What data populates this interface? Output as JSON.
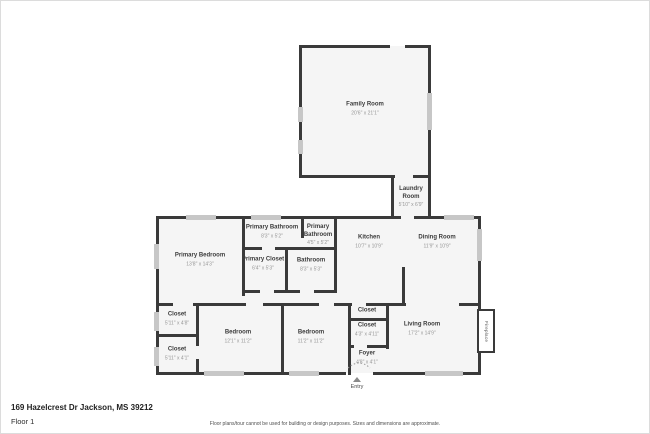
{
  "address": "169 Hazelcrest Dr Jackson, MS 39212",
  "floor_label": "Floor 1",
  "disclaimer": "Floor plans/tour cannot be used for building or design purposes. Sizes and dimensions are approximate.",
  "entry_label": "Entry",
  "fireplace_label": "Fireplace",
  "colors": {
    "wall": "#3a3a3a",
    "window": "#c7c7c7",
    "room_fill": "#f5f5f5",
    "room_name_text": "#3c3c3c",
    "dimension_text": "#979797"
  },
  "rooms": [
    {
      "name": "Family Room",
      "dims": "20'6\" x 21'1\""
    },
    {
      "name": "Laundry Room",
      "dims": "5'10\" x 6'9\""
    },
    {
      "name": "Primary Bathroom",
      "dims": "8'3\" x 5'2\""
    },
    {
      "name": "Primary Bathroom",
      "dims": "4'5\" x 5'2\""
    },
    {
      "name": "Kitchen",
      "dims": "10'7\" x 10'9\""
    },
    {
      "name": "Dining Room",
      "dims": "11'9\" x 10'9\""
    },
    {
      "name": "Primary Bedroom",
      "dims": "13'8\" x 14'3\""
    },
    {
      "name": "Primary Closet",
      "dims": "6'4\" x 5'3\""
    },
    {
      "name": "Bathroom",
      "dims": "8'3\" x 5'3\""
    },
    {
      "name": "Closet",
      "dims": "5'11\" x 4'8\""
    },
    {
      "name": "Closet",
      "dims": "5'11\" x 4'1\""
    },
    {
      "name": "Bedroom",
      "dims": "12'1\" x 11'2\""
    },
    {
      "name": "Bedroom",
      "dims": "11'2\" x 11'2\""
    },
    {
      "name": "Closet",
      "dims": ""
    },
    {
      "name": "Closet",
      "dims": "4'3\" x 4'11\""
    },
    {
      "name": "Foyer",
      "dims": "4'8\" x 4'1\""
    },
    {
      "name": "Living Room",
      "dims": "17'2\" x 14'9\""
    }
  ]
}
